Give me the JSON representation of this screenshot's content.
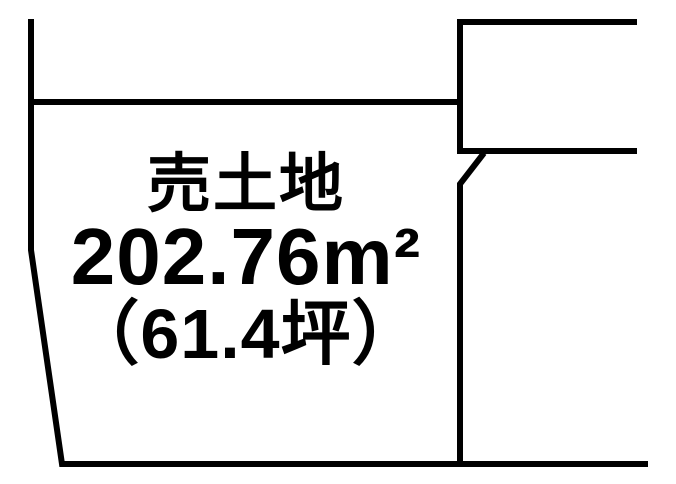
{
  "diagram": {
    "type": "land-plot-diagram",
    "background_color": "#ffffff",
    "line_color": "#000000",
    "line_width_px": 6,
    "parcel_label": {
      "title": "売土地",
      "area_m2": "202.76m²",
      "area_m2_value": 202.76,
      "area_tsubo": "（61.4坪）",
      "area_tsubo_value": 61.4
    },
    "outline": {
      "main_boundary_points": "31,19 31,250 62,464 648,464",
      "upper_boundary_points": "28,102 460,102",
      "neighbor_lot_points": "637,22 460,22 460,151 637,151",
      "right_boundary_points": "484,153 460,184 460,464"
    }
  }
}
